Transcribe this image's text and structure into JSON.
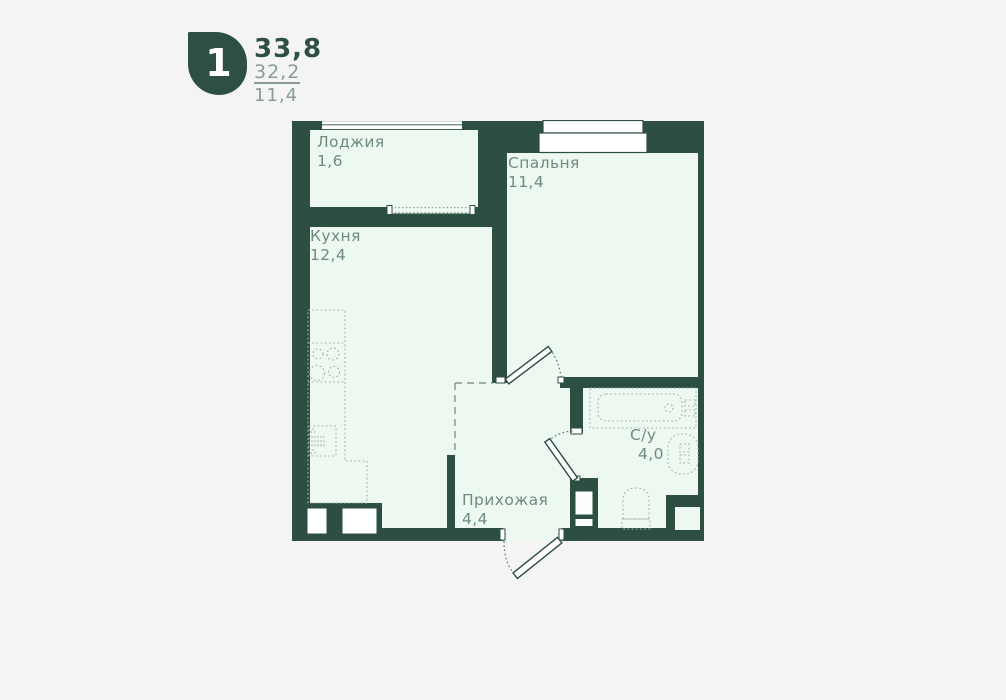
{
  "header": {
    "rooms_count": "1",
    "area_total": "33,8",
    "area_living": "32,2",
    "area_kitchen": "11,4"
  },
  "plan": {
    "rooms": [
      {
        "name": "Лоджия",
        "area": "1,6"
      },
      {
        "name": "Спальня",
        "area": "11,4"
      },
      {
        "name": "Кухня",
        "area": "12,4"
      },
      {
        "name": "Прихожая",
        "area": "4,4"
      },
      {
        "name": "С/у",
        "area": "4,0"
      }
    ],
    "colors": {
      "wall": "#2d4e43",
      "room_fill": "#edf8f1",
      "label_text": "#6f8b7e",
      "fixture_stroke": "#9fb6aa",
      "page_background": "#f4f4f5",
      "accent_dark": "#2e4f43",
      "secondary_text": "#8b9c95"
    }
  }
}
